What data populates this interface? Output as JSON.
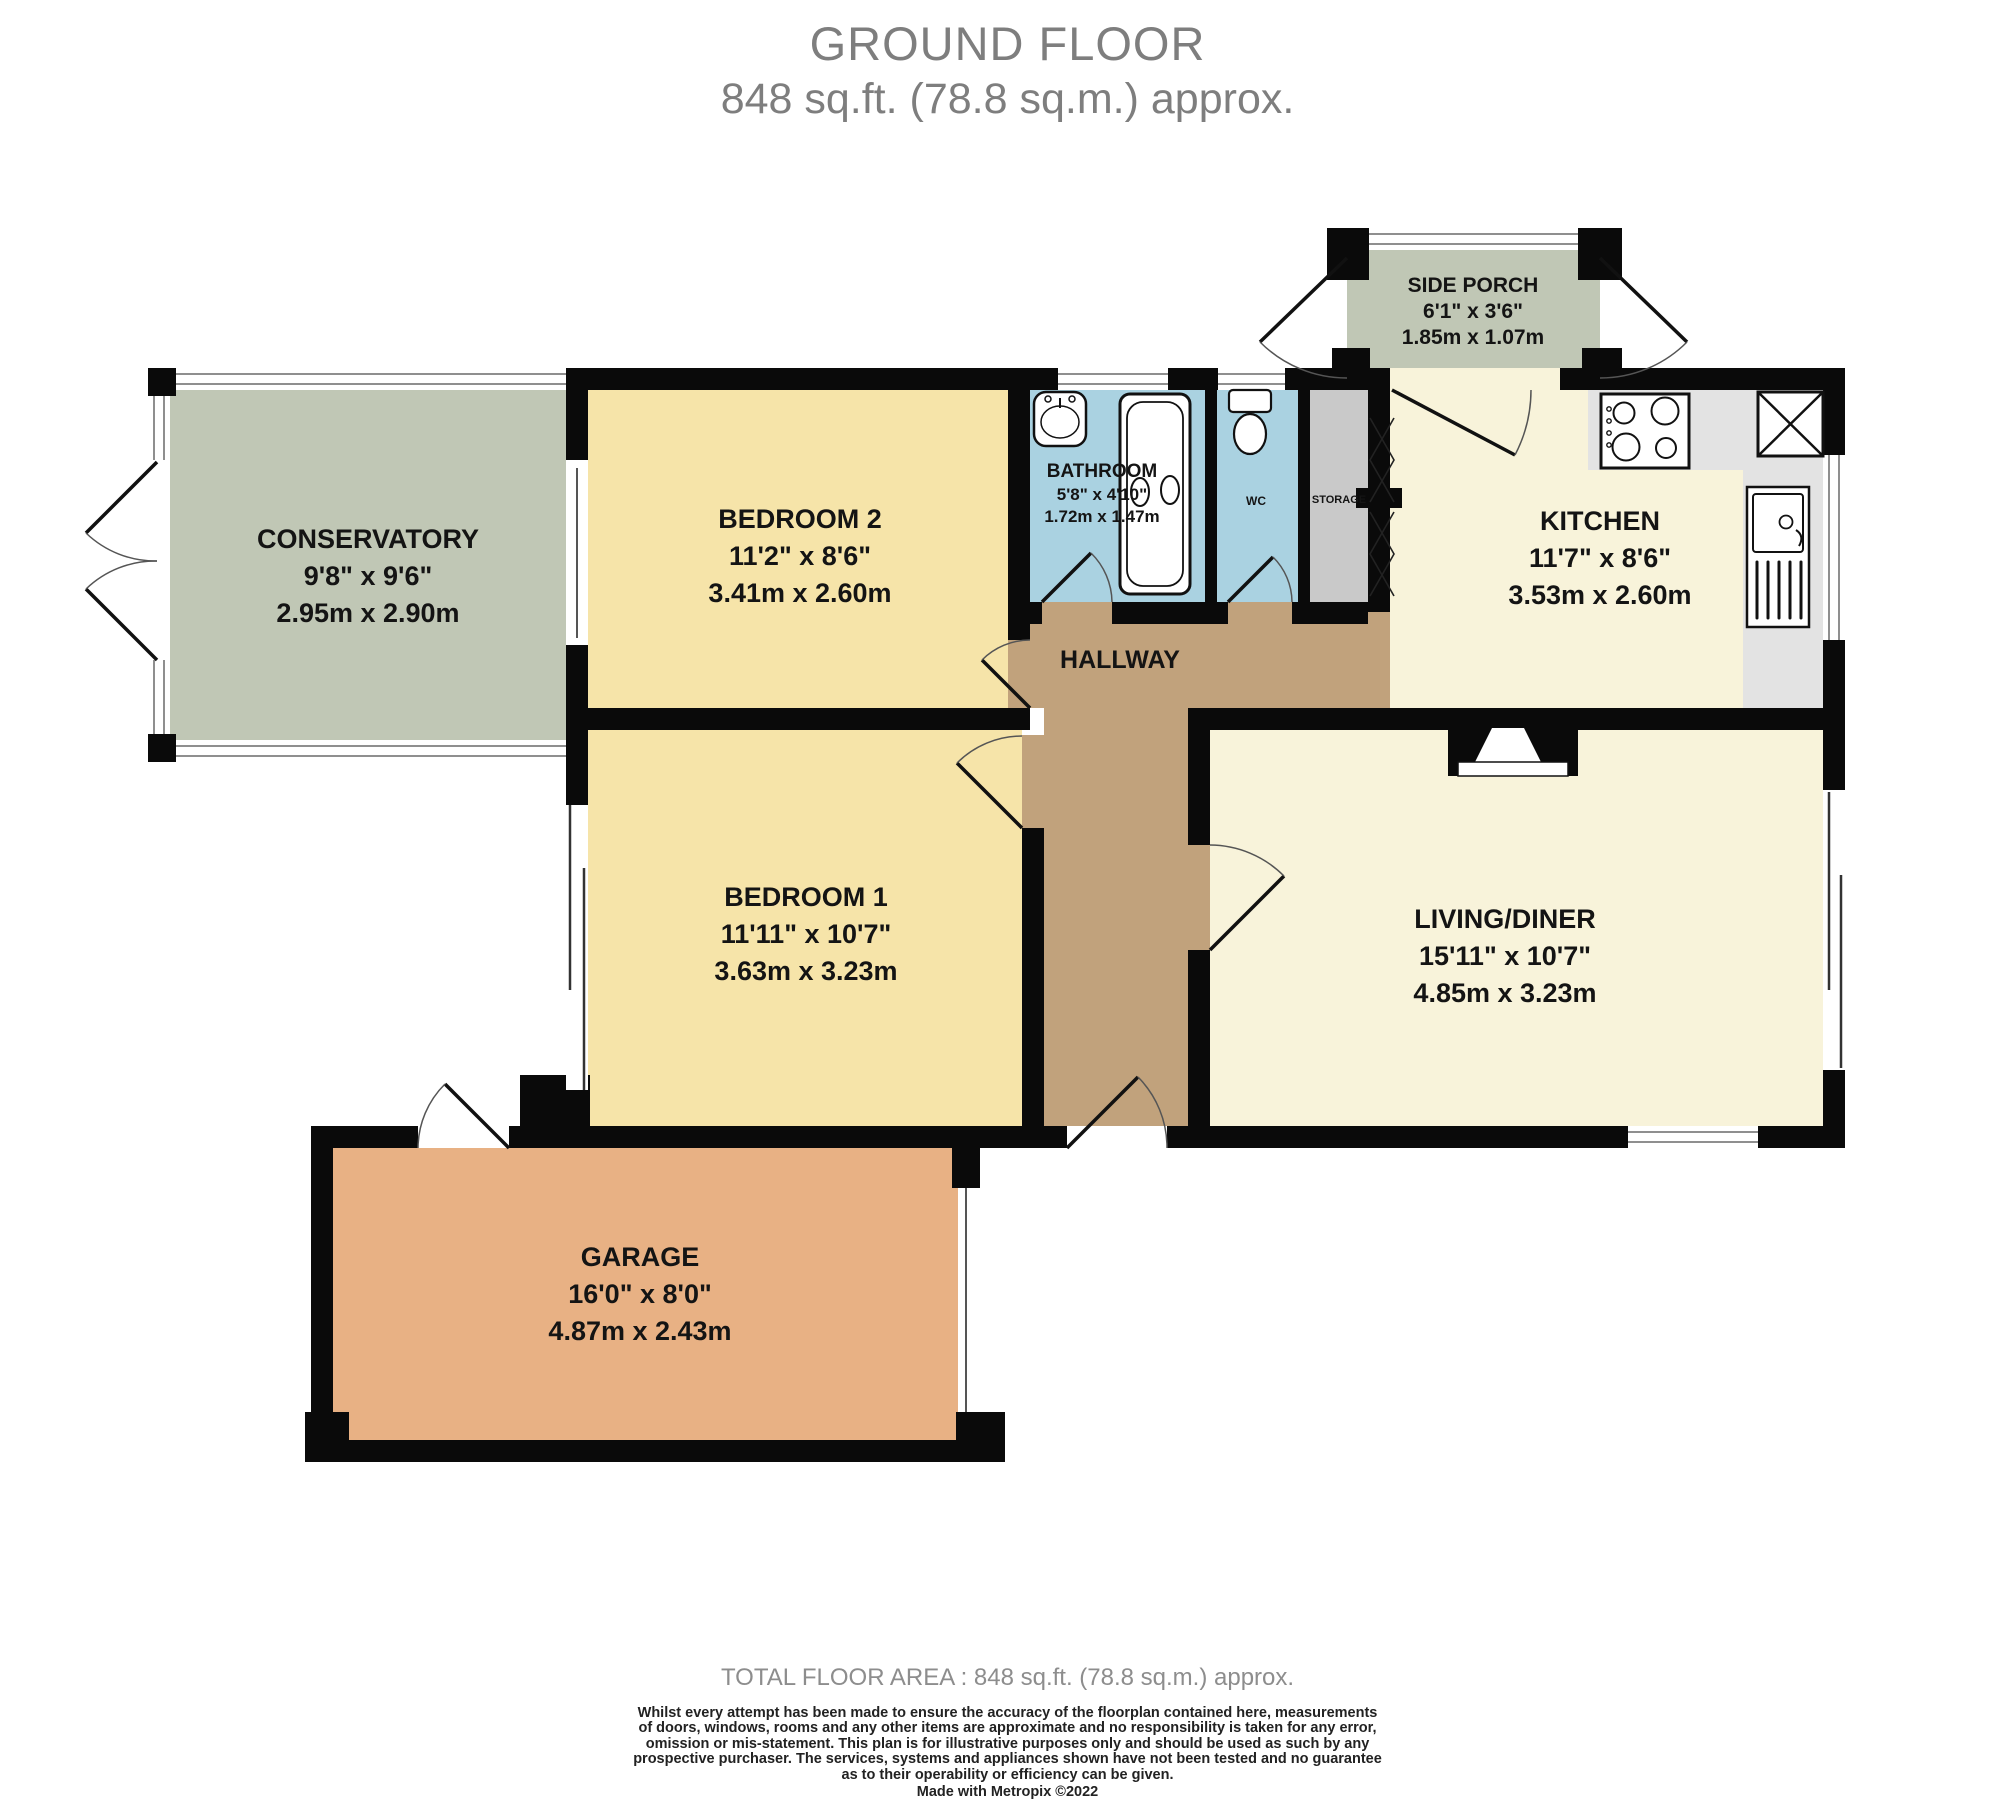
{
  "title": {
    "line1": "GROUND FLOOR",
    "line2": "848 sq.ft. (78.8 sq.m.) approx."
  },
  "rooms": {
    "conservatory": {
      "name": "CONSERVATORY",
      "imperial": "9'8\"  x 9'6\"",
      "metric": "2.95m  x 2.90m"
    },
    "bedroom2": {
      "name": "BEDROOM 2",
      "imperial": "11'2\"  x 8'6\"",
      "metric": "3.41m  x 2.60m"
    },
    "bathroom": {
      "name": "BATHROOM",
      "imperial": "5'8\"  x 4'10\"",
      "metric": "1.72m  x 1.47m"
    },
    "wc": {
      "name": "WC"
    },
    "storage": {
      "name": "STORAGE"
    },
    "side_porch": {
      "name": "SIDE PORCH",
      "imperial": "6'1\"  x 3'6\"",
      "metric": "1.85m  x 1.07m"
    },
    "kitchen": {
      "name": "KITCHEN",
      "imperial": "11'7\"  x 8'6\"",
      "metric": "3.53m  x 2.60m"
    },
    "hallway": {
      "name": "HALLWAY"
    },
    "bedroom1": {
      "name": "BEDROOM 1",
      "imperial": "11'11\"  x 10'7\"",
      "metric": "3.63m  x 3.23m"
    },
    "living_diner": {
      "name": "LIVING/DINER",
      "imperial": "15'11\"  x 10'7\"",
      "metric": "4.85m  x 3.23m"
    },
    "garage": {
      "name": "GARAGE",
      "imperial": "16'0\"  x 8'0\"",
      "metric": "4.87m  x 2.43m"
    }
  },
  "footer": {
    "total": "TOTAL FLOOR AREA : 848 sq.ft. (78.8 sq.m.) approx.",
    "disclaimer_lines": [
      "Whilst every attempt has been made to ensure the accuracy of the floorplan contained here, measurements",
      "of doors, windows, rooms and any other items are approximate and no responsibility is taken for any error,",
      "omission or mis-statement. This plan is for illustrative purposes only and should be used as such by any",
      "prospective purchaser. The services, systems and appliances shown have not been tested and no guarantee",
      "as to their operability or efficiency can be given."
    ],
    "credit": "Made with Metropix ©2022"
  },
  "colors": {
    "wall": "#0a0a0a",
    "bedroom_fill": "#f6e4a9",
    "living_kitchen_fill": "#f8f3da",
    "hallway_fill": "#c1a27c",
    "bathroom_fill": "#aad2e1",
    "storage_fill": "#c9c9c9",
    "conservatory_fill": "#c0c7b5",
    "garage_fill": "#e8b184",
    "counter_fill": "#e3e3e3",
    "title_text": "#7e7e7e",
    "footer_text": "#8d8d8d"
  }
}
